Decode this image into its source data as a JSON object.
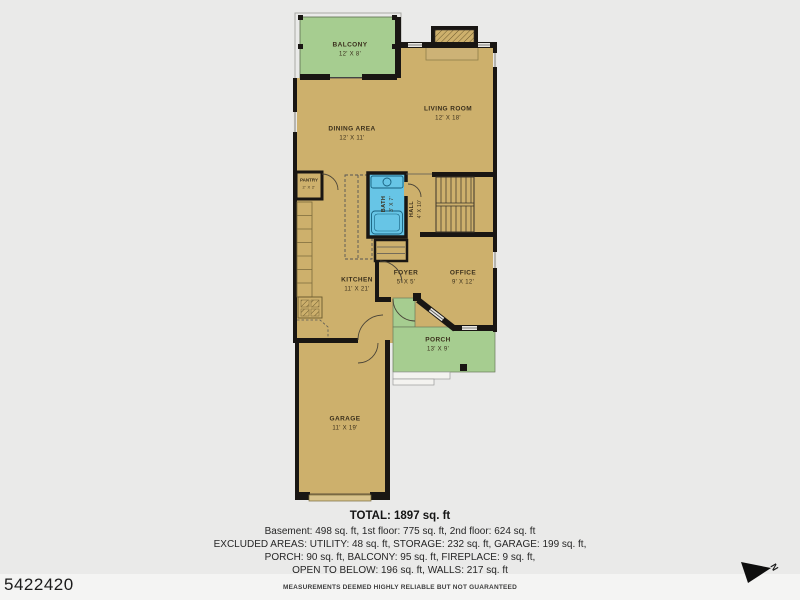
{
  "plan": {
    "rooms": [
      {
        "name": "BALCONY",
        "dims": "12' X 8'"
      },
      {
        "name": "LIVING ROOM",
        "dims": "12' X 18'"
      },
      {
        "name": "DINING AREA",
        "dims": "12' X 11'"
      },
      {
        "name": "PANTRY",
        "dims": "2' X 2'"
      },
      {
        "name": "BATH",
        "dims": "3' X 7'"
      },
      {
        "name": "HALL",
        "dims": "4' X 10'"
      },
      {
        "name": "KITCHEN",
        "dims": "11' X 21'"
      },
      {
        "name": "FOYER",
        "dims": "5' X 5'"
      },
      {
        "name": "OFFICE",
        "dims": "9' X 12'"
      },
      {
        "name": "PORCH",
        "dims": "13' X 9'"
      },
      {
        "name": "GARAGE",
        "dims": "11' X 19'"
      }
    ],
    "colors": {
      "floor": "#cdb06c",
      "outdoor_area": "#a6cd90",
      "bathroom": "#67c5e6",
      "walls": "#191613",
      "background": "#eaeae9"
    }
  },
  "footer": {
    "total": "TOTAL: 1897 sq. ft",
    "line1": "Basement: 498 sq. ft, 1st floor: 775 sq. ft, 2nd floor: 624 sq. ft",
    "line2": "EXCLUDED AREAS: UTILITY: 48 sq. ft, STORAGE: 232 sq. ft, GARAGE: 199 sq. ft,",
    "line3": "PORCH: 90 sq. ft, BALCONY: 95 sq. ft, FIREPLACE: 9 sq. ft,",
    "line4": "OPEN TO BELOW: 196 sq. ft, WALLS: 217 sq. ft",
    "disclaimer": "MEASUREMENTS DEEMED HIGHLY RELIABLE BUT NOT GUARANTEED"
  },
  "watermark": {
    "listing_id": "5422420"
  },
  "compass": {
    "label": "N"
  }
}
